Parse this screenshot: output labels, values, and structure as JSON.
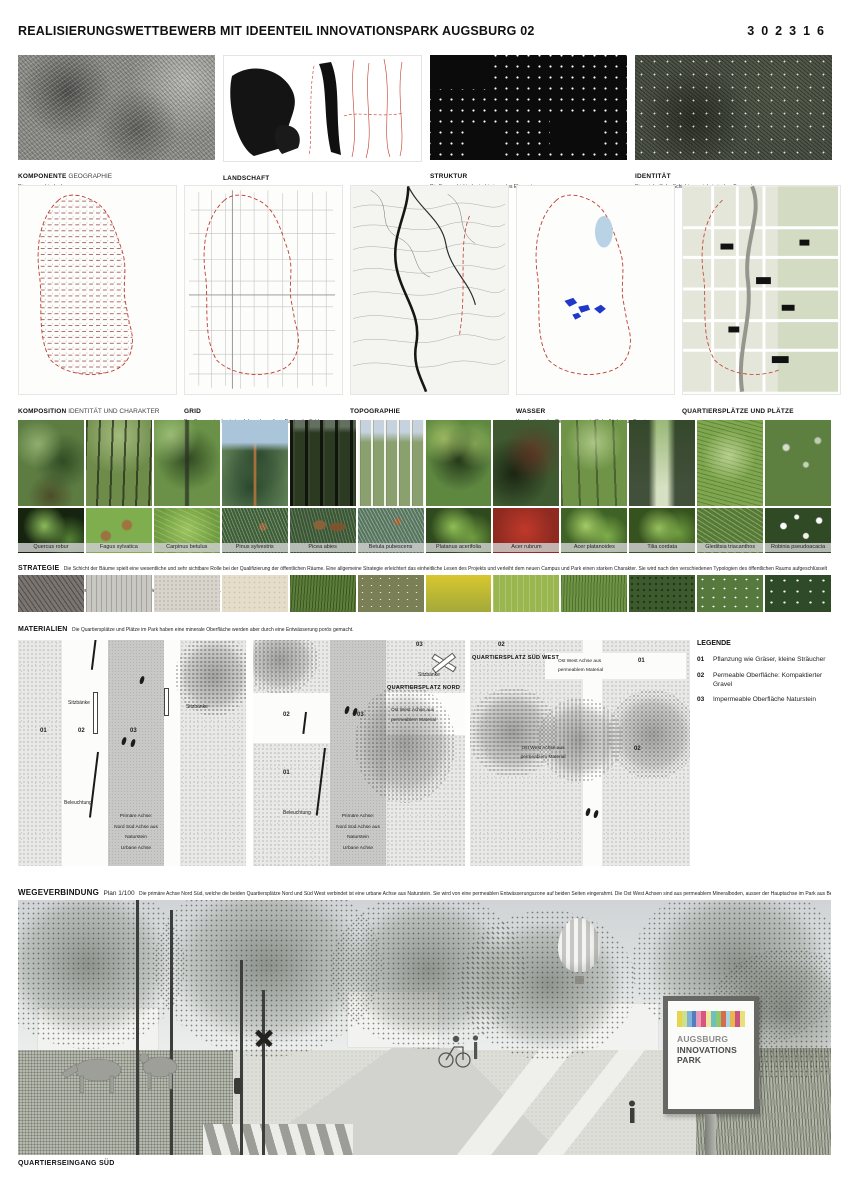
{
  "header": {
    "title": "REALISIERUNGSWETTBEWERB MIT IDEENTEIL INNOVATIONSPARK AUGSBURG 02",
    "code": "302316"
  },
  "analysis_row": {
    "panels": [
      {
        "bold": "KOMPONENTE",
        "rest": " GEOGRAPHIE",
        "subtitle": "Die geographische Lage"
      },
      {
        "bold": "LANDSCHAFT",
        "rest": "",
        "subtitle": "Die existierende Landschaftsstruktur"
      },
      {
        "bold": "STRUKTUR",
        "rest": "",
        "subtitle": "Die Baumschicht als strukturierendes Element"
      },
      {
        "bold": "IDENTITÄT",
        "rest": "",
        "subtitle": "Eine einheitliche Schicht aus einheimischen Baumarten"
      }
    ]
  },
  "concept_row": {
    "panels": [
      {
        "bold": "KOMPOSITION",
        "rest": " IDENTITÄT UND CHARAKTER",
        "subtitle": ""
      },
      {
        "bold": "GRID",
        "rest": "",
        "subtitle": "Das Baumraster basiert auf dem ehemaligen Raster der Felder."
      },
      {
        "bold": "TOPOGRAPHIE",
        "rest": "",
        "subtitle": ""
      },
      {
        "bold": "WASSER",
        "rest": "",
        "subtitle": "Verarbeitung des Regenwassers in Sickerflächen un Bassins"
      },
      {
        "bold": "QUARTIERSPLÄTZE UND PLÄTZE",
        "rest": "",
        "subtitle": ""
      }
    ]
  },
  "trees": {
    "species": [
      "Quercus robur",
      "Fagus sylvatica",
      "Carpinus betulus",
      "Pinus sylvestris",
      "Picea abies",
      "Betula pubescens",
      "Platanus acerifolia",
      "Acer rubrum",
      "Acer platanoides",
      "Tilia cordata",
      "Gleditsia triacanthos",
      "Robinia pseudoacacia"
    ]
  },
  "strategie": {
    "label": "STRATEGIE",
    "text": "Die Schicht der Bäume spielt eine wesentliche und sehr sichtbare Rolle bei der Qualifizierung der öffentlichen Räume. Eine allgemeine Strategie erleichtert das einheitliche Lesen des Projekts und verleiht dem neuen Campus und Park einen starken Charakter. Sie wird nach den verschiedenen Typologien des öffentlichen Raums aufgeschlüsselt und trägt dazu bei, verschiedene Bereiche des Projekts zu identifizieren und anzuerkennen."
  },
  "materialien": {
    "label": "MATERIALIEN",
    "text": "Die Quartiersplätze und Plätze im Park haben eine minerale Oberfläche werden aber durch eine Entwässerung porös gemacht.",
    "swatches": [
      "asphalt",
      "stone-plank",
      "gravel-light",
      "gravel-beige",
      "tall-grass",
      "meadow",
      "rapeseed-field",
      "lawn",
      "grass-field",
      "ivy",
      "flowering-shrub",
      "flowering-hedge"
    ]
  },
  "plans": {
    "nordsued": {
      "num01": "01",
      "num02": "02",
      "num03": "03",
      "sitzbaenke_left": "Sitzbänke",
      "sitzbaenke_right": "Sitzbänke",
      "beleuchtung": "Beleuchtung",
      "achse": "Primäre Achse:\nNord Süd Achse aus\nNaturstein\nUrbane Achse",
      "caption": "Ausschnitte Nord Süd Achse"
    },
    "gruenachse_nord": {
      "num01": "01",
      "num02": "02",
      "num03_mid": "03",
      "num03_top": "03",
      "sitzbaenke": "Sitzbänke",
      "platz_title": "QUARTIERSPLATZ NORD",
      "achse_ow": "Ost West Achse aus\npermeablem Material",
      "beleuchtung": "Beleuchtung",
      "achse": "Primäre Achse:\nNord Süd Achse aus\nNaturstein\nUrbane Achse",
      "caption": "Ost West Grünachse Nord"
    },
    "gruenachse": {
      "num01": "01",
      "num02_top": "02",
      "num02_right": "02",
      "platz_title": "QUARTIERSPLATZ SÜD WEST",
      "achse_ow_top": "Ost West Achse aus\npermeablem Material",
      "achse_ow_mid": "Ost West Achse aus\npermeablem Material",
      "caption": "Ost West Grünachse"
    }
  },
  "legende": {
    "title": "LEGENDE",
    "items": [
      {
        "num": "01",
        "text": "Pflanzung wie Gräser, kleine Sträucher"
      },
      {
        "num": "02",
        "text": "Permeable Oberfläche: Kompaktierter Gravel"
      },
      {
        "num": "03",
        "text": "Impermeable Oberfläche Naturstein"
      }
    ]
  },
  "wegeverbindung": {
    "label": "WEGEVERBINDUNG",
    "plan_ref": "Plan 1/100",
    "text": "Die primäre Achse Nord Süd, welche die beiden Quartiersplätze Nord und Süd West verbindet  ist eine urbane Achse aus Naturstein. Sie wird von eine permeablen Entwässerungszone auf beiden Seiten eingerahmt. Die Ost West Achsen sind aus permeablem Mineralboden, ausser der Hauptachse im Park aus Beton."
  },
  "rendering": {
    "sign": {
      "line1": "AUGSBURG",
      "line2": "INNOVATIONS",
      "line3": "PARK",
      "stripe_colors": [
        "#e8d44d",
        "#cfe08a",
        "#7fb3d9",
        "#4f7fbf",
        "#e89ab8",
        "#d9547f",
        "#f0e6a0",
        "#6fc0b8",
        "#8fc96f",
        "#d96a4f",
        "#a8d4e8",
        "#e8b84d",
        "#c9547f",
        "#e8e07a"
      ]
    },
    "caption": "QUARTIERSEINGANG SÜD"
  },
  "colors": {
    "accent_red": "#c0392b",
    "water_blue": "#2038c8"
  }
}
